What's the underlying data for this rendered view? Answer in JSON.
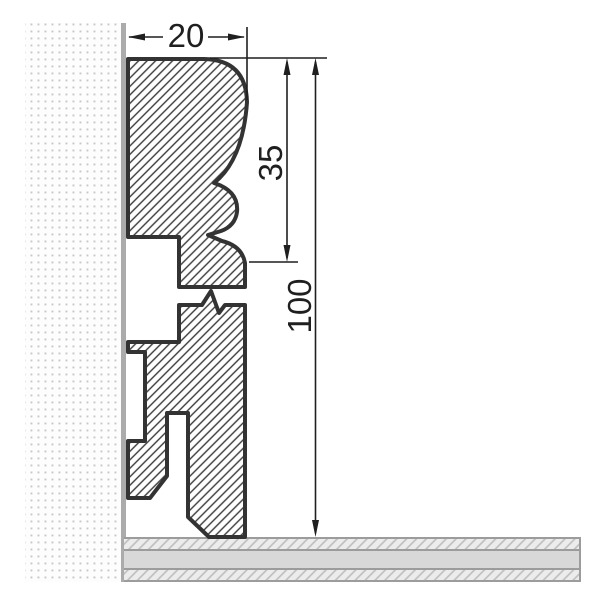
{
  "dimensions": {
    "width": {
      "label": "20"
    },
    "upper_section_height": {
      "label": "35"
    },
    "total_height": {
      "label": "100"
    }
  },
  "colors": {
    "background": "#ffffff",
    "profile_outline": "#333333",
    "hatch_line": "#3a3a3a",
    "dimension_ink": "#1f1f1f",
    "wall_dot": "#c7c7c7",
    "wall_edge_line": "#ababab",
    "floor_solid": "#d8d8d8",
    "floor_hatch_bg": "#ececec",
    "floor_hatch_line": "#bdbdbd",
    "floor_border": "#9c9c9c"
  }
}
